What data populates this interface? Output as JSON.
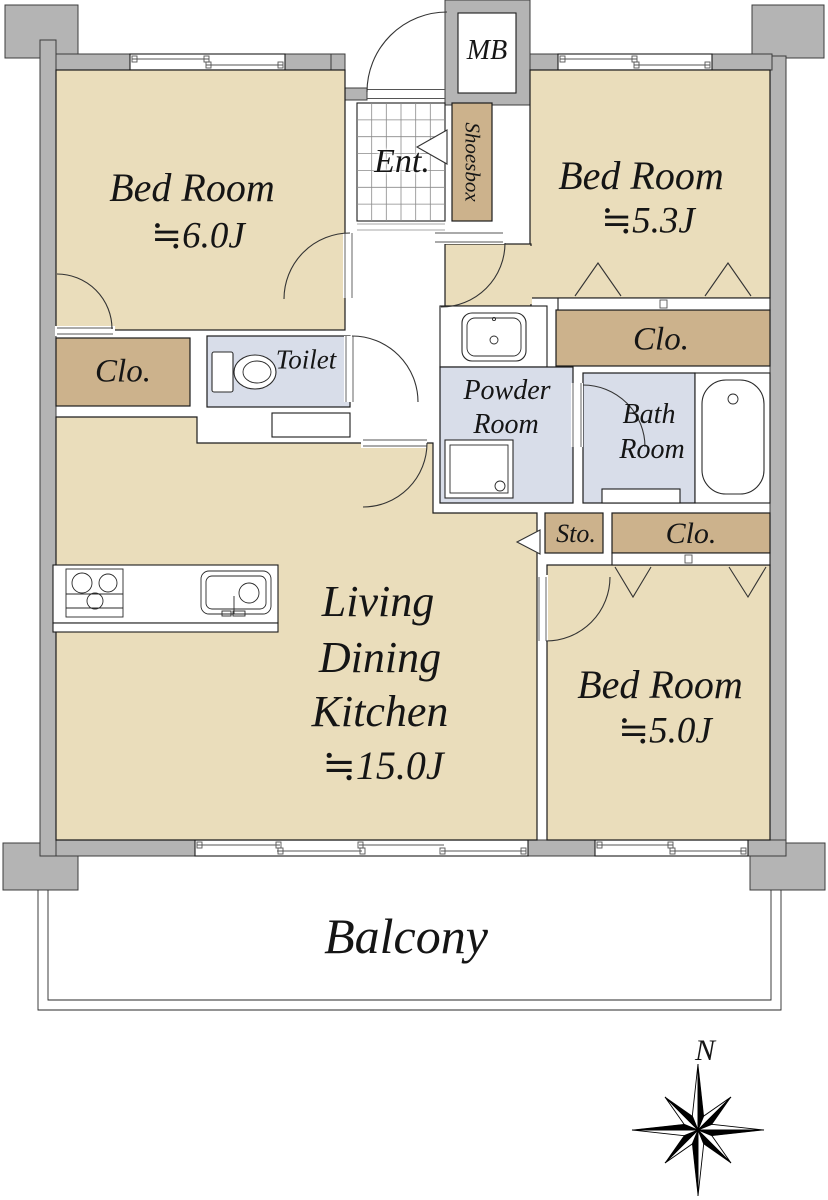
{
  "labels": {
    "bedroom1_name": "Bed Room",
    "bedroom1_size": "≒6.0J",
    "bedroom2_name": "Bed Room",
    "bedroom2_size": "≒5.3J",
    "bedroom3_name": "Bed Room",
    "bedroom3_size": "≒5.0J",
    "ldk_line1": "Living",
    "ldk_line2": "Dining",
    "ldk_line3": "Kitchen",
    "ldk_size": "≒15.0J",
    "entrance": "Ent.",
    "meter_box": "MB",
    "shoesbox": "Shoesbox",
    "closet_left": "Clo.",
    "closet_upper_right": "Clo.",
    "closet_lower_right": "Clo.",
    "storage": "Sto.",
    "toilet": "Toilet",
    "powder_line1": "Powder",
    "powder_line2": "Room",
    "bath_line1": "Bath",
    "bath_line2": "Room",
    "balcony": "Balcony",
    "compass_north": "N"
  },
  "colors": {
    "floor": "#eaddbb",
    "closet": "#ccb28c",
    "wet_floor": "#d8dde9",
    "wall": "#b4b4b4",
    "outline": "#1c1c1c"
  }
}
